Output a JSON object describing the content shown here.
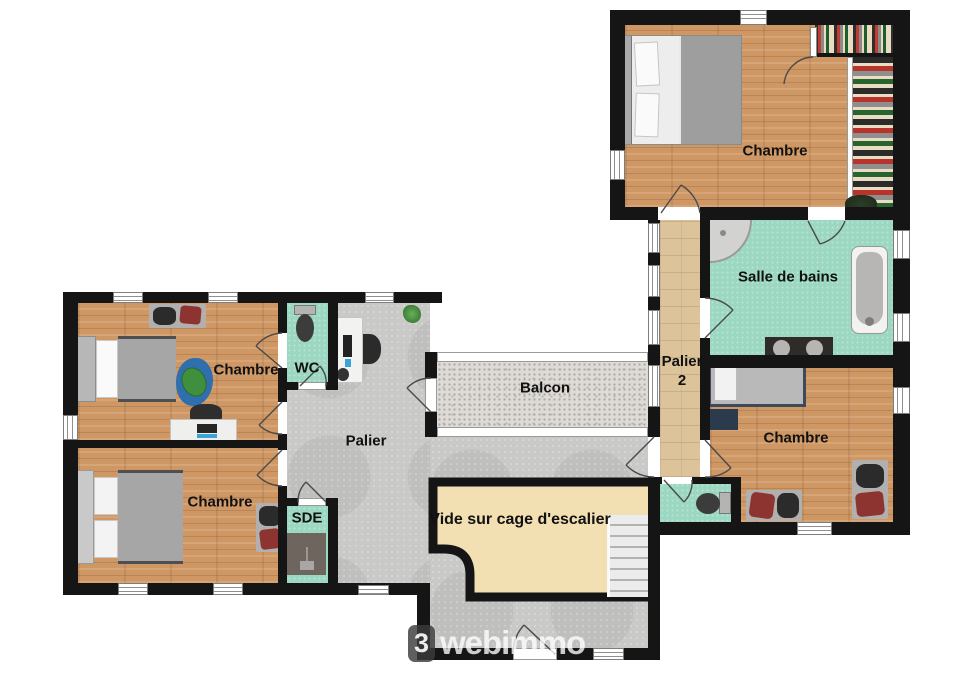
{
  "labels": {
    "chambre_top_right": "Chambre",
    "salle_de_bains": "Salle de bains",
    "palier_2": "Palier 2",
    "chambre_right": "Chambre",
    "chambre_top_left": "Chambre",
    "wc": "WC",
    "palier": "Palier",
    "balcon": "Balcon",
    "chambre_bottom_left": "Chambre",
    "sde": "SDE",
    "vide_escalier": "Vide sur cage d'escalier"
  },
  "watermark": {
    "logo_glyph": "3",
    "brand": "webimmo"
  },
  "palette": {
    "wall": "#151515",
    "wood": "#cf9764",
    "wood_light": "#dcc39a",
    "tile_teal": "#9bd7c1",
    "palier_gray": "#c9c9c7",
    "balcony_gray": "#dedbd6",
    "vide_beige": "#f2dfb2",
    "stair_tread": "#ececec",
    "label": "#111111",
    "red_accent": "#8e3430",
    "blue_accent": "#3aa3d8"
  }
}
